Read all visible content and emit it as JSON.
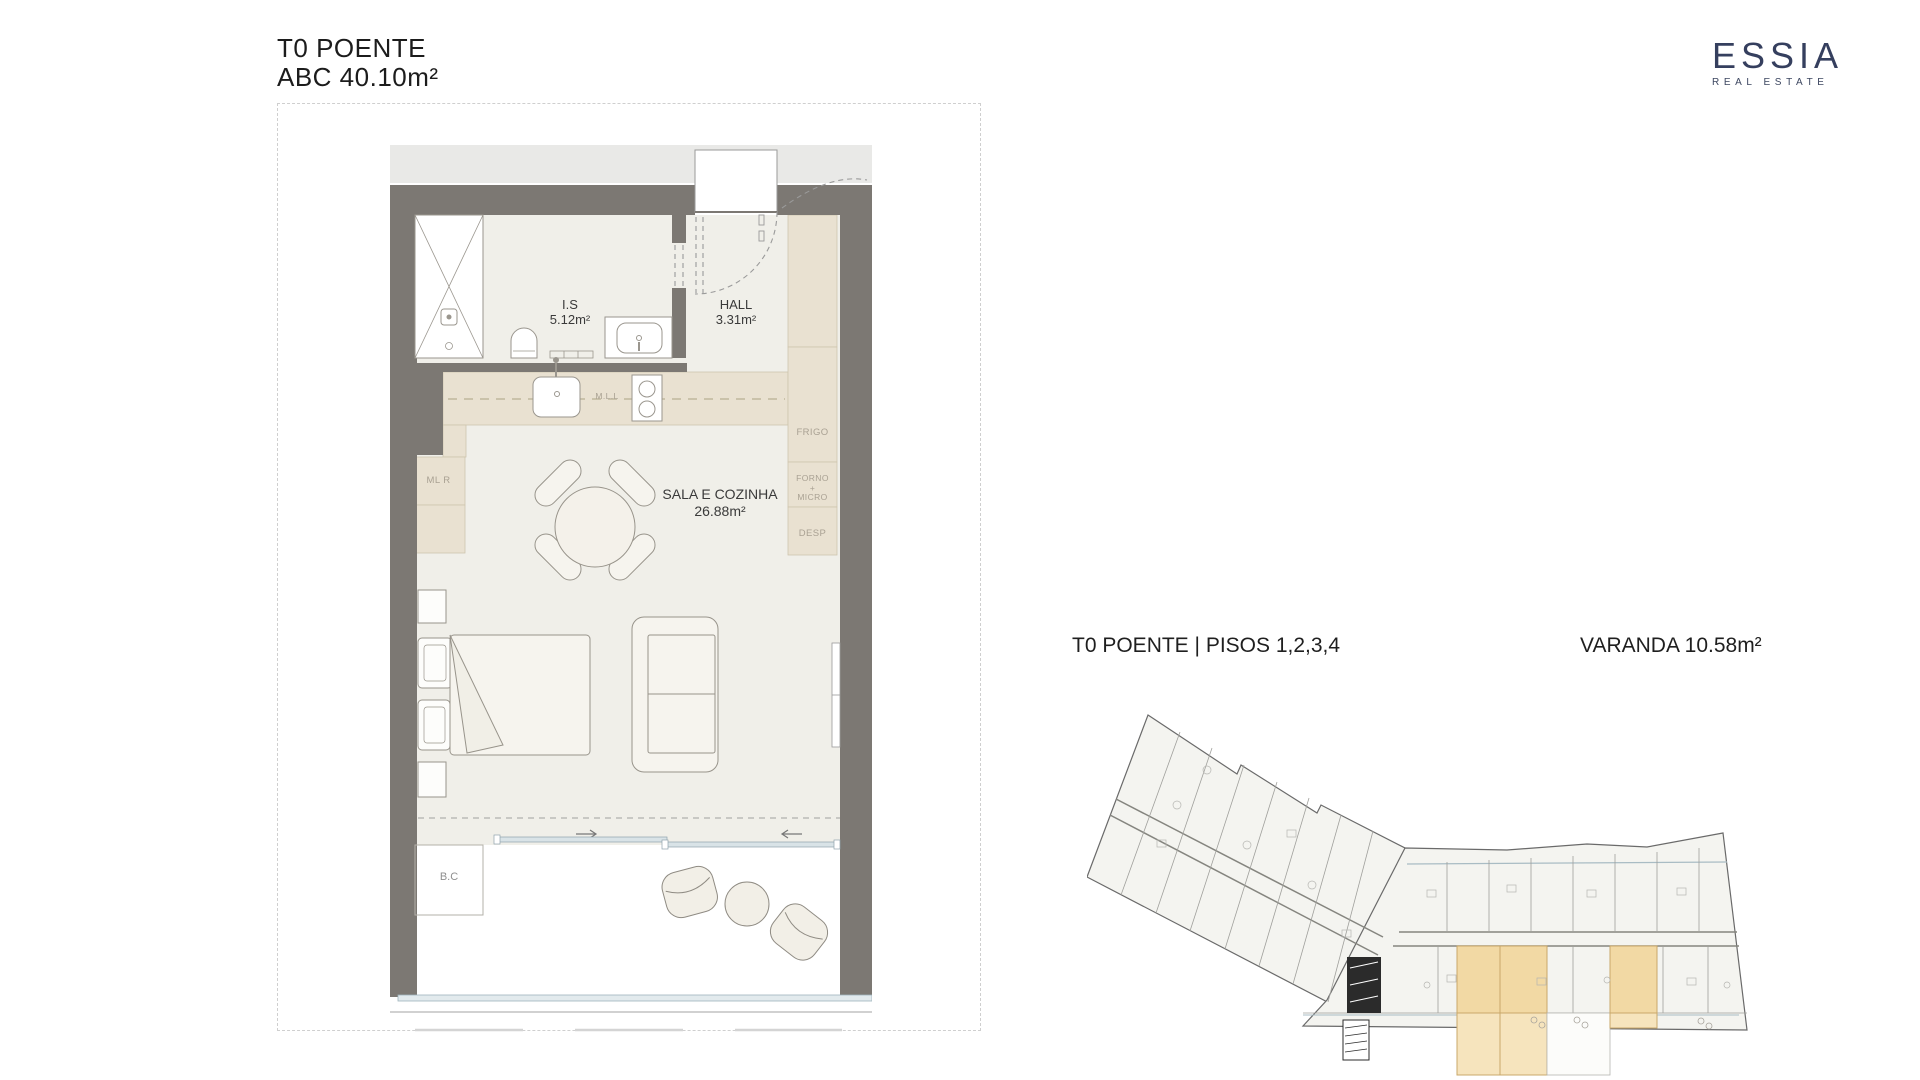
{
  "header": {
    "title_line1": "T0 POENTE",
    "title_line2": "ABC 40.10m²"
  },
  "brand": {
    "name": "ESSIA",
    "tagline": "REAL ESTATE"
  },
  "floorplan": {
    "rooms": [
      {
        "name": "I.S",
        "area": "5.12m²"
      },
      {
        "name": "HALL",
        "area": "3.31m²"
      },
      {
        "name": "SALA E COZINHA",
        "area": "26.88m²"
      }
    ],
    "cabinet_labels": {
      "frigo": "FRIGO",
      "forno_1": "FORNO",
      "forno_2": "+",
      "forno_3": "MICRO",
      "desp": "DESP",
      "mll": "M.L.L",
      "mlr": "ML R",
      "bc": "B.C"
    }
  },
  "overview": {
    "title": "T0 POENTE | PISOS 1,2,3,4",
    "balcony_label": "VARANDA 10.58m²"
  },
  "colors": {
    "wall": "#7c7873",
    "floor": "#f0efe9",
    "cabinet": "#e9e1d1",
    "corridor": "#e9e9e7",
    "highlight_unit": "#f2d9a4",
    "highlight_balcony": "#f6e4bd",
    "glass": "#a9bcc4",
    "brand_navy": "#353f5e"
  }
}
